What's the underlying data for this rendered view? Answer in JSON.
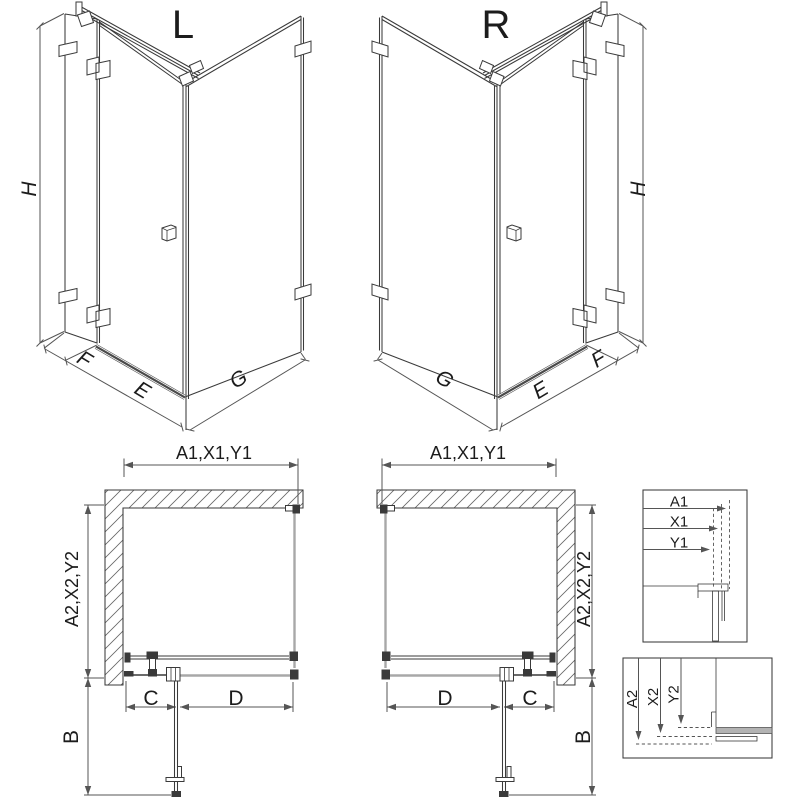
{
  "colors": {
    "line": "#3a3a3a",
    "dim": "#555555",
    "silver": "#a8a8a8",
    "background": "#ffffff"
  },
  "iso_left": {
    "title": "L",
    "height_dim": "H",
    "fixed_panel_dim": "F",
    "door_dim": "E",
    "side_panel_dim": "G"
  },
  "iso_right": {
    "title": "R",
    "height_dim": "H",
    "fixed_panel_dim": "F",
    "door_dim": "E",
    "side_panel_dim": "G"
  },
  "plan_left": {
    "width_dim": "A1,X1,Y1",
    "depth_dim": "A2,X2,Y2",
    "door_width_dim": "C",
    "panel_width_dim": "D",
    "entry_dim": "B"
  },
  "plan_right": {
    "width_dim": "A1,X1,Y1",
    "depth_dim": "A2,X2,Y2",
    "door_width_dim": "C",
    "panel_width_dim": "D",
    "entry_dim": "B"
  },
  "detail_width_box": {
    "labels": [
      "A1",
      "X1",
      "Y1"
    ]
  },
  "detail_depth_box": {
    "labels": [
      "A2",
      "X2",
      "Y2"
    ]
  }
}
